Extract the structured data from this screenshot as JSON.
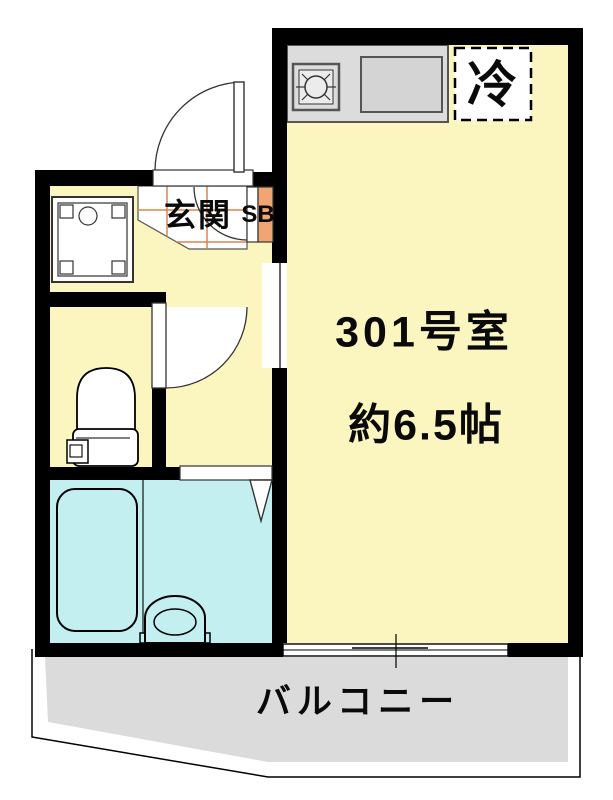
{
  "labels": {
    "entrance": "玄関",
    "shoe_box": "SB",
    "refrigerator_space": "冷",
    "room_number": "301号室",
    "room_area": "約6.5帖",
    "balcony": "バルコニー"
  },
  "colors": {
    "floor_yellow": "#FBF5BF",
    "bathroom_cyan": "#C3EFF1",
    "balcony_gray": "#DBDBDB",
    "kitchen_counter_gray": "#DCDCDC",
    "shoe_box_orange": "#F0A572",
    "tile_grid_orange": "#E2824E",
    "wall_black": "#000000"
  }
}
